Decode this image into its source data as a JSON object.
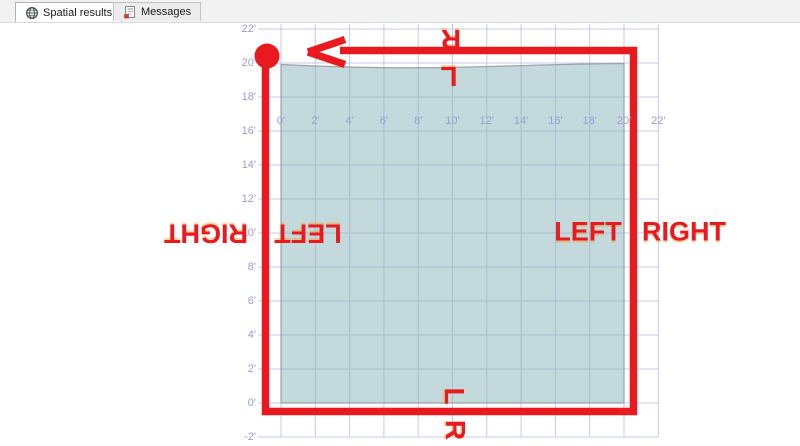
{
  "tabs": [
    {
      "label": "Spatial results",
      "icon": "globe-icon",
      "active": true
    },
    {
      "label": "Messages",
      "icon": "messages-icon",
      "active": false
    }
  ],
  "chart": {
    "type": "spatial-grid",
    "x_axis_labels": [
      "0'",
      "2'",
      "4'",
      "6'",
      "8'",
      "10'",
      "12'",
      "14'",
      "16'",
      "18'",
      "20'",
      "22'"
    ],
    "y_axis_labels": [
      "22'",
      "20'",
      "18'",
      "16'",
      "14'",
      "12'",
      "10'",
      "8'",
      "6'",
      "4'",
      "2'",
      "0'",
      "-2'"
    ],
    "polygon": {
      "x_range_ft": [
        0,
        20
      ],
      "y_range_ft": [
        0,
        20
      ]
    },
    "grid_color": "#c6c8ec",
    "axis_label_color": "#989dd8",
    "polygon_fill": "rgba(137,179,184,0.50)",
    "polygon_edge": "#9aa4a8"
  },
  "annotations": {
    "color": "#e81a20",
    "top_edge_outside_letter": "R",
    "top_edge_inside_letter": "L",
    "bottom_edge_inside_letter": "L",
    "bottom_edge_outside_letter": "R",
    "left_edge_outside_word": "RIGHT",
    "left_edge_inside_word": "LEFT",
    "right_edge_inside_word": "LEFT",
    "right_edge_outside_word": "RIGHT"
  }
}
